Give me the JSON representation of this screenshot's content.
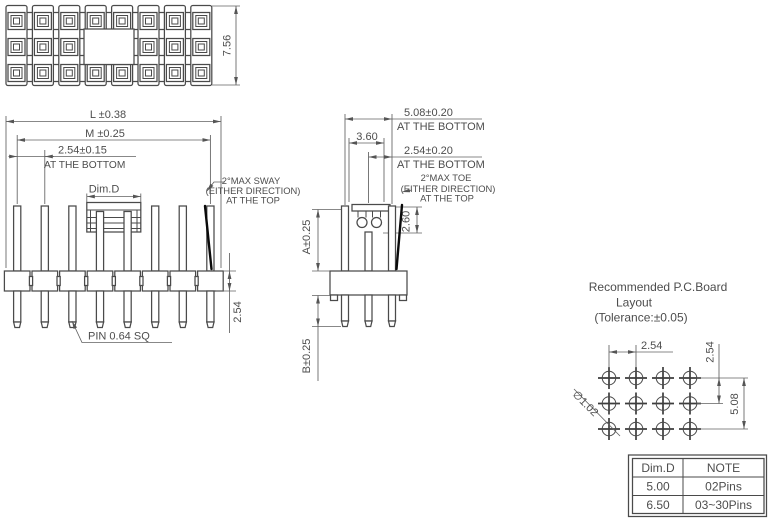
{
  "colors": {
    "line": "#4a4a4a",
    "dimension": "#616161",
    "text": "#4d4d4d",
    "highlight_black": "#0a0a0a",
    "background": "#ffffff"
  },
  "top_view": {
    "height_dim": "7.56"
  },
  "front_view": {
    "dim_l": "L ±0.38",
    "dim_m": "M ±0.25",
    "dim_pitch": "2.54±0.15",
    "pitch_note": "AT THE BOTTOM",
    "dim_d": "Dim.D",
    "sway1": "2°MAX SWAY",
    "sway2": "(EITHER DIRECTION)",
    "sway3": "AT THE  TOP",
    "pin_label": "PIN 0.64 SQ",
    "dim_body": "2.54"
  },
  "side_view": {
    "dim_span": "5.08±0.20",
    "span_note": "AT THE BOTTOM",
    "dim_cap": "3.60",
    "dim_pitch": "2.54±0.20",
    "pitch_note": "AT THE BOTTOM",
    "toe1": "2°MAX TOE",
    "toe2": "(EITHER DIRECTION)",
    "toe3": "AT THE  TOP",
    "dim_clip": "2.60",
    "dim_a": "A±0.25",
    "dim_b": "B±0.25"
  },
  "pcb": {
    "title1": "Recommended P.C.Board",
    "title2": "Layout",
    "title3": "(Tolerance:±0.05)",
    "dim_h": "2.54",
    "dim_v": "2.54",
    "dim_span": "5.08",
    "hole_dia": "∅1.02"
  },
  "table": {
    "headers": [
      "Dim.D",
      "NOTE"
    ],
    "rows": [
      [
        "5.00",
        "02Pins"
      ],
      [
        "6.50",
        "03~30Pins"
      ]
    ]
  }
}
